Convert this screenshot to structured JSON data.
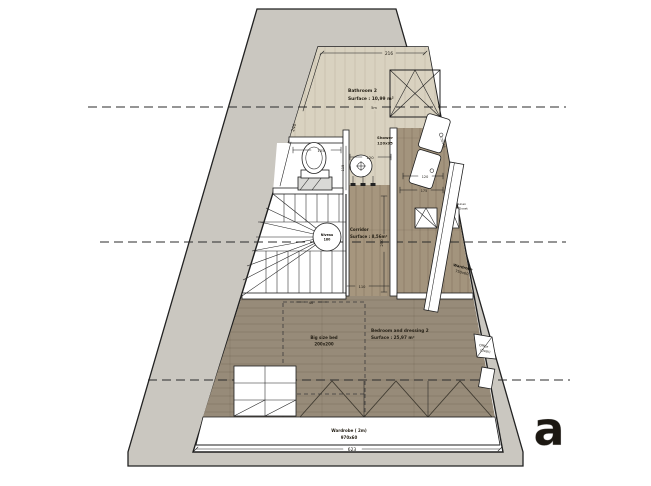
{
  "rooms": {
    "bathroom": {
      "name": "Bathroom 2",
      "surface": "Surface : 10,99 m²"
    },
    "corridor": {
      "name": "Corridor",
      "surface": "Surface : 8,56m²"
    },
    "bedroom": {
      "name": "Bedroom and dressing 2",
      "surface": "Surface : 25,97 m²"
    }
  },
  "labels": {
    "shower": {
      "name": "Shower",
      "size": "120x95"
    },
    "stair": {
      "line1": "Niveau",
      "line2": "180"
    },
    "bed": {
      "name": "Big size bed",
      "size": "200x200"
    },
    "wardrobe_side": {
      "name": "Wardrobe",
      "size": "750x60"
    },
    "wardrobe_bottom": {
      "name": "Wardrobe ( 2m)",
      "size": "970x60"
    },
    "closet": {
      "line1": "Linen",
      "line2": "Closet"
    },
    "office": {
      "line1": "Office",
      "line2": "(Desk)"
    },
    "vanity": {
      "size": "150x46"
    }
  },
  "dimensions": {
    "top": "216",
    "left_slope": "240",
    "toilet": "105",
    "niche": "115",
    "niche_b": "45",
    "shower": "120",
    "section": "5m",
    "right_a": "120",
    "right_b": "175",
    "corridor_v": "250",
    "corridor_w": "110",
    "opening": "40",
    "bottom": "623"
  },
  "colors": {
    "wall": "#cac7c0",
    "bathroom_floor": "#d9d2c0",
    "corridor_floor": "#a6967e",
    "bedroom_floor": "#978b79"
  },
  "watermark": {
    "letter": "a"
  }
}
